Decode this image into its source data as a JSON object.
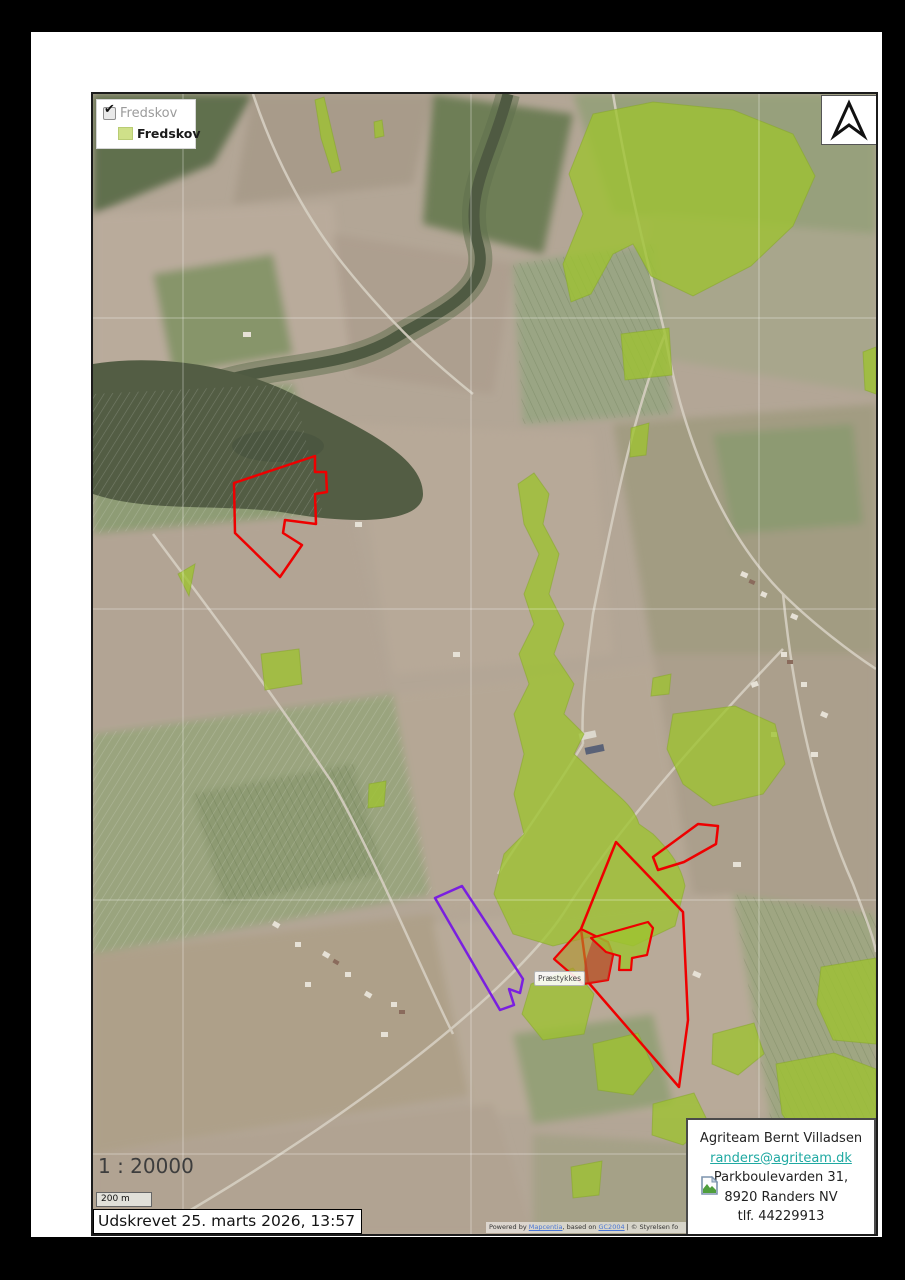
{
  "legend": {
    "layer": {
      "label": "Fredskov",
      "checked": true,
      "check_glyph": "✔"
    },
    "symbol": {
      "label": "Fredskov",
      "swatch_color": "#cfe089"
    }
  },
  "scale": {
    "ratio_text": "1 : 20000",
    "bar_label": "200 m"
  },
  "printed_label": "Udskrevet 25. marts 2026, 13:57",
  "map": {
    "feature_label": "Præstykkes"
  },
  "attribution": {
    "prefix": "Powered by ",
    "link1": "Mapcentia",
    "middle": ", based on ",
    "link2": "GC2004",
    "suffix": " | © Styrelsen fo"
  },
  "info_box": {
    "name": "Agriteam Bernt Villadsen",
    "email": "randers@agriteam.dk",
    "address_line1": "Parkboulevarden 31,",
    "address_line2": "8920 Randers NV",
    "phone": "tlf. 44229913"
  },
  "colors": {
    "fredskov-swatch": "#cfe089",
    "fredskov-overlay": "#9ec32f",
    "red-outline": "#ee0000",
    "purple-outline": "#7a1fe0",
    "email-link": "#1fa9a2",
    "attr-link": "#4a76d4",
    "water": "#535d44"
  }
}
